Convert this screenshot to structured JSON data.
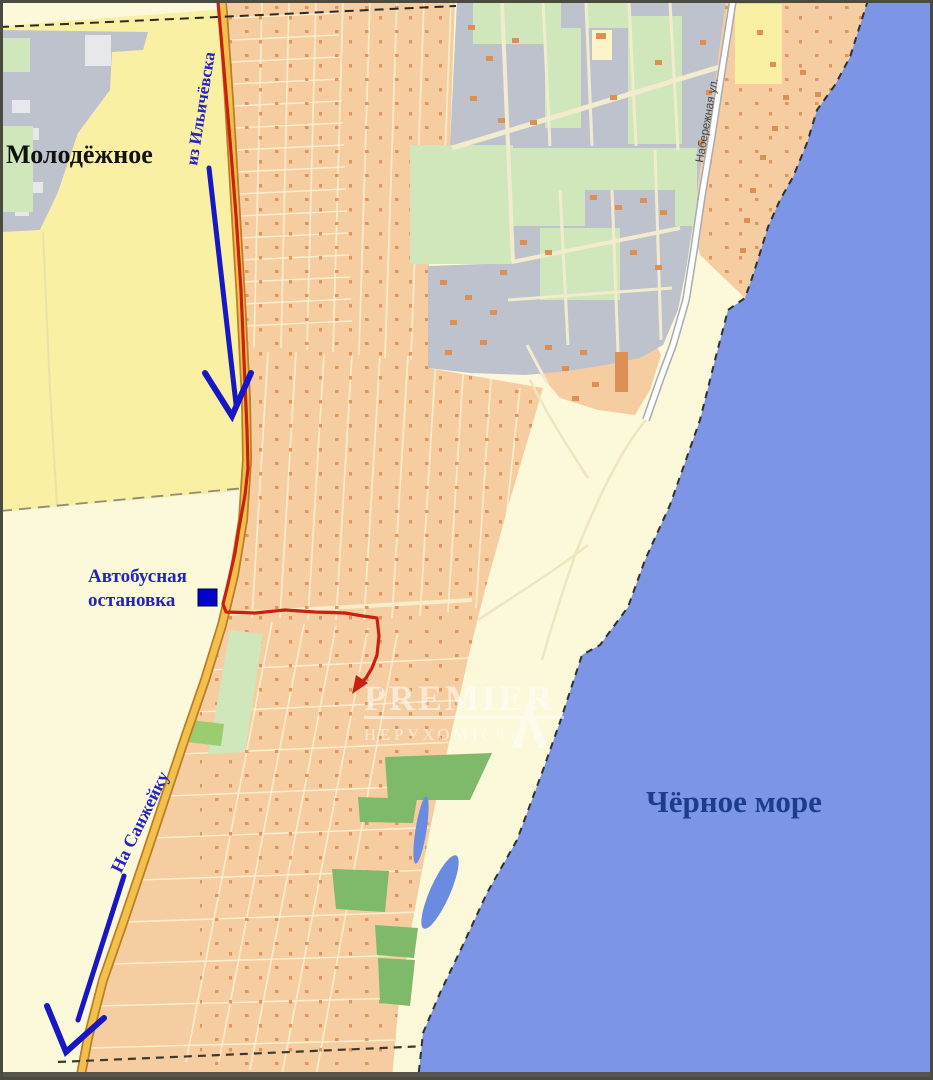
{
  "map": {
    "region_labels": {
      "settlement": "Молодёжное",
      "sea": "Чёрное море",
      "embankment_street": "Набережная ул."
    },
    "route_labels": {
      "from_city": "из Ильичёвска",
      "to_village": "На Санжейку",
      "bus_stop_line1": "Автобусная",
      "bus_stop_line2": "остановка"
    },
    "watermark": {
      "brand": "PREMIER",
      "subtitle": "НЕРУХОМІСТЬ"
    },
    "colors": {
      "sea": "#7D95E6",
      "sea_label": "#1C3C8E",
      "cream": "#FCF8DA",
      "field_yellow": "#F9F0A4",
      "residential": "#F5CDA1",
      "industrial": "#BEC2CD",
      "green_light": "#CFE7BB",
      "green_dark": "#7FBA6A",
      "green_bright": "#9ACD6E",
      "pond": "#6A8CE0",
      "road_fill": "#F2C14C",
      "road_edge": "#BE7B28",
      "white_road_edge": "#A7ABB3",
      "route_red": "#C9200F",
      "arrow_blue": "#1717C6",
      "label_blue": "#2424BE",
      "marker_blue": "#0202CC",
      "building_orange": "#DE8F55",
      "boundary_dash": "#3C3A30",
      "frame": "#4B4A40"
    }
  }
}
